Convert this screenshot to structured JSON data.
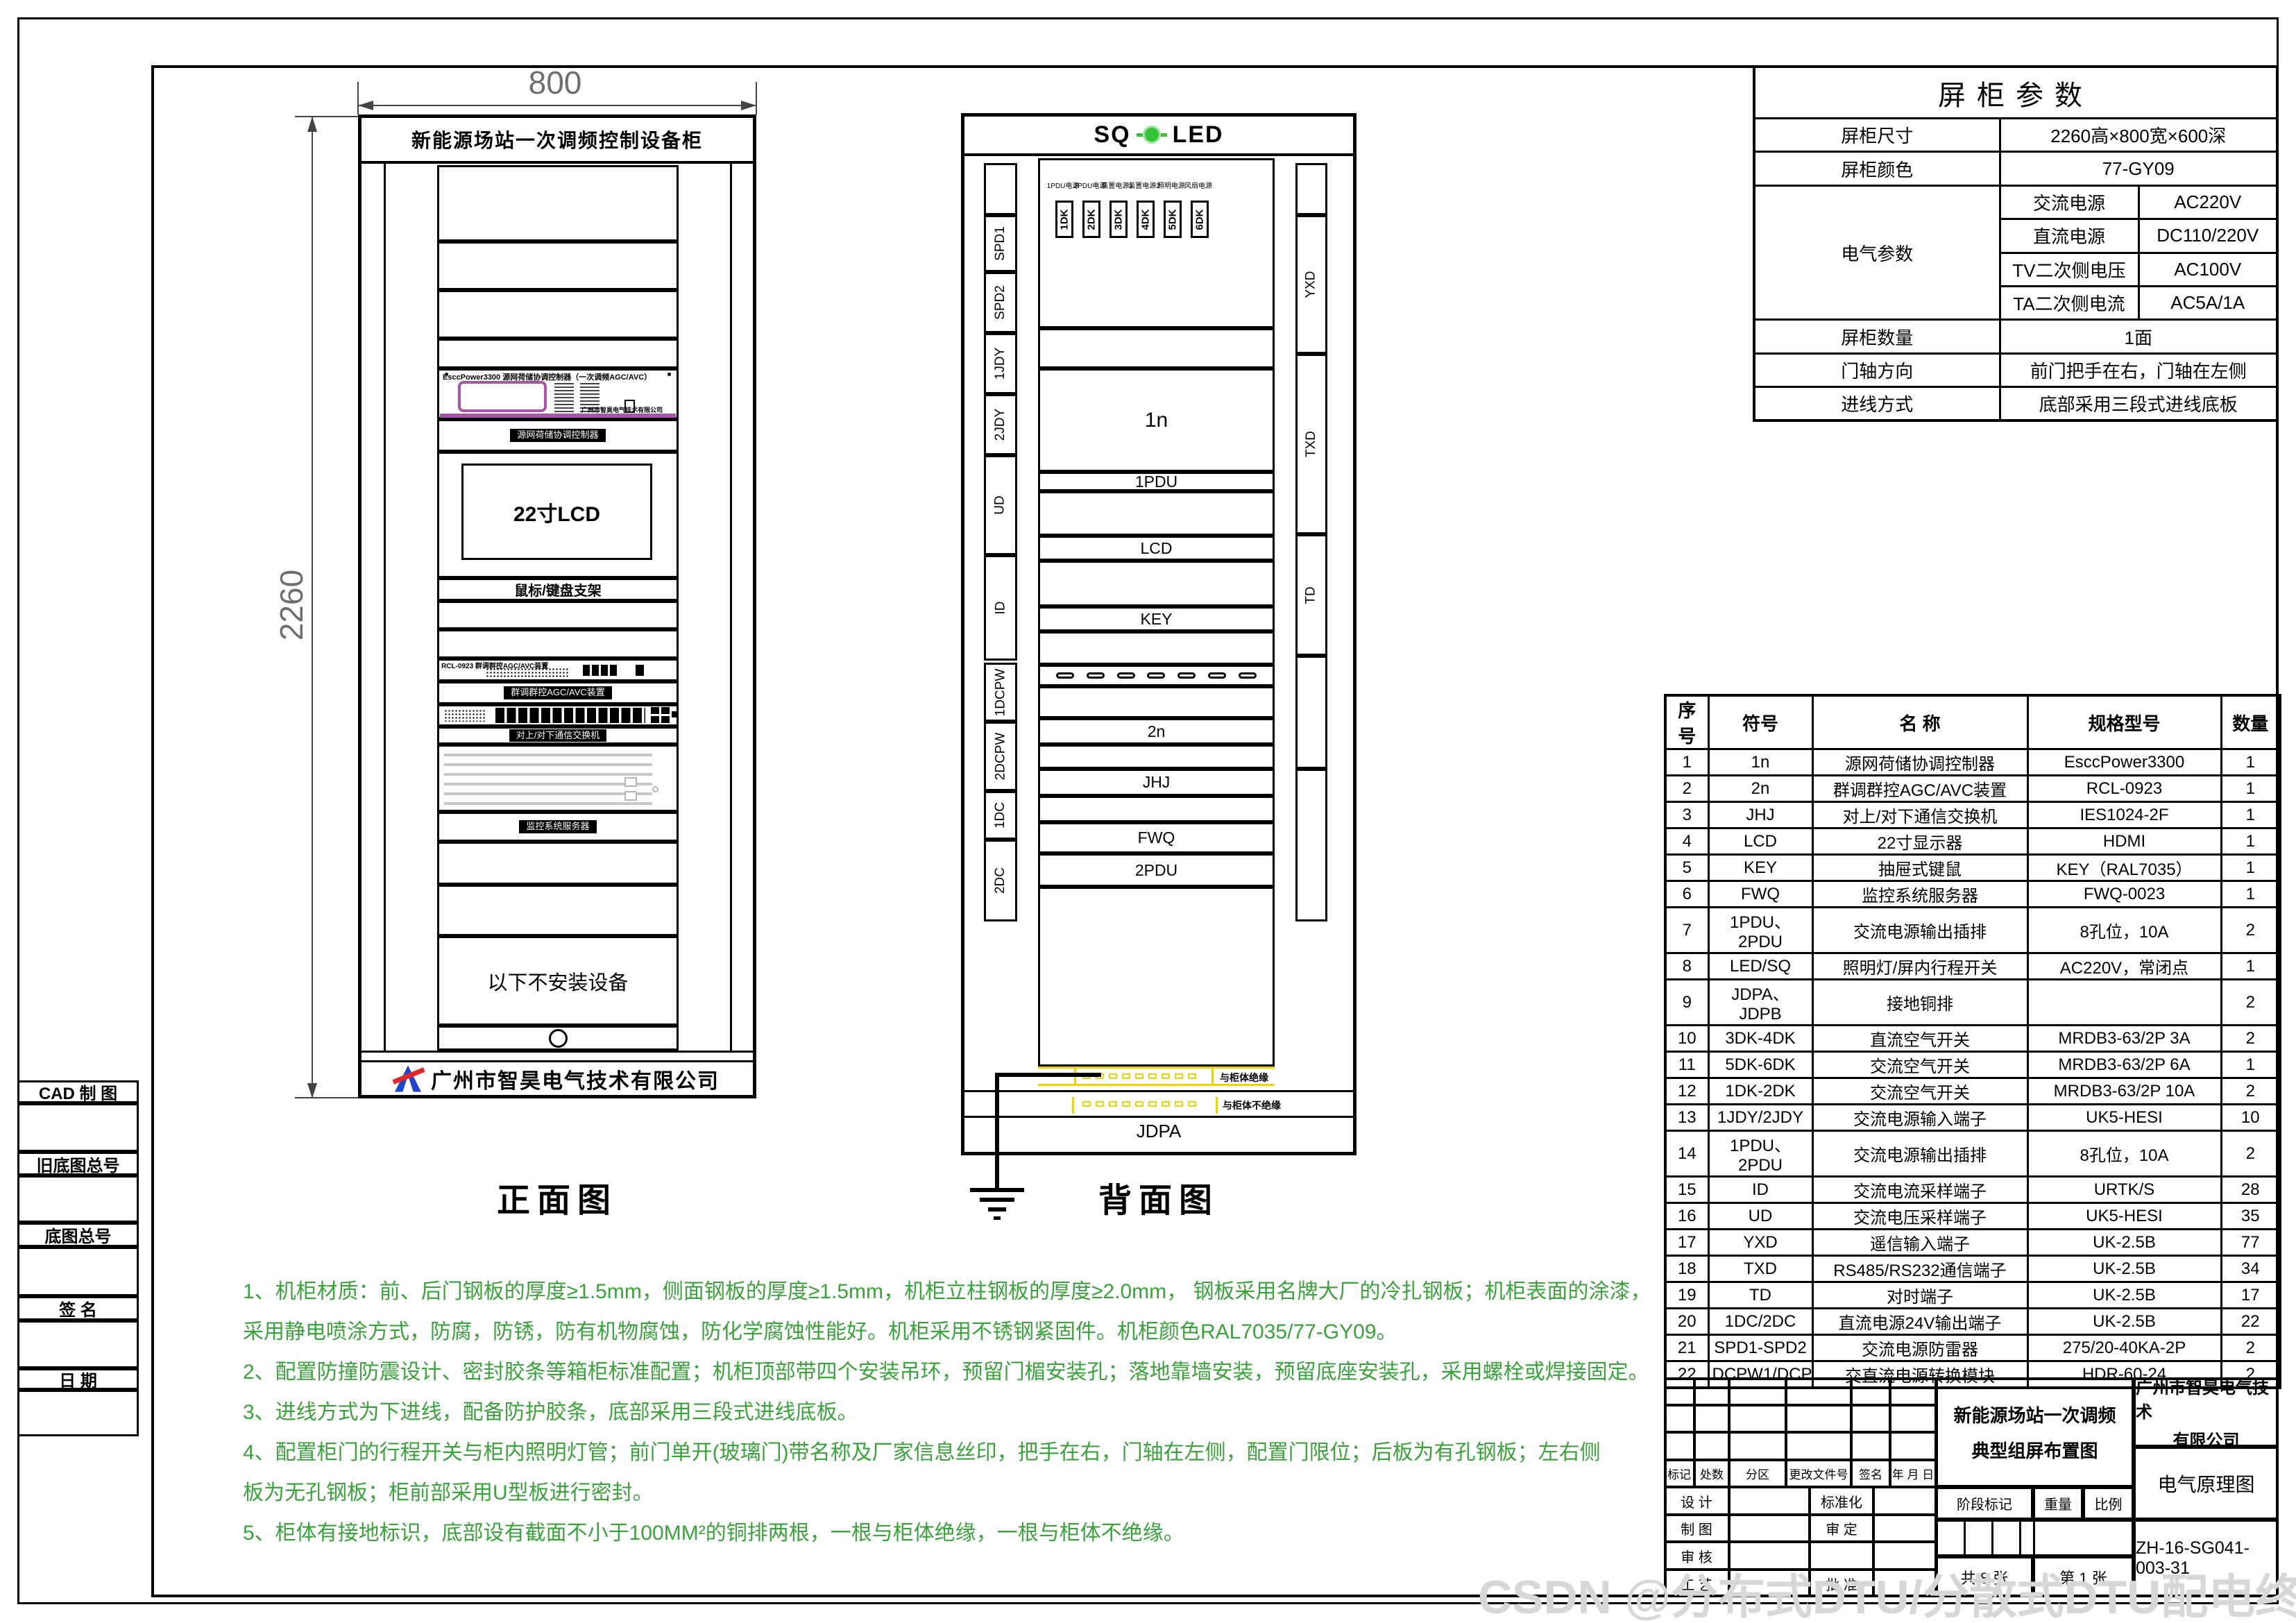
{
  "watermark": "CSDN @分布式DTU/分散式DTU配电终端",
  "side_panel": {
    "labels": [
      "CAD 制 图",
      "旧底图总号",
      "底图总号",
      "签  名",
      "日  期"
    ]
  },
  "front_view": {
    "caption": "正面图",
    "dim_width": "800",
    "dim_height": "2260",
    "header": "新能源场站一次调频控制设备柜",
    "controller_label": "EsccPower3300 源网荷储协调控制器（一次调频AGC/AVC）",
    "controller_brand": "广州市智昊电气技术有限公司",
    "nameplate_controller": "源网荷储协调控制器",
    "switch_label": "RCL-0923 群调群控AGC/AVC装置",
    "nameplate_switch": "群调群控AGC/AVC装置",
    "nameplate_comm": "对上/对下通信交换机",
    "nameplate_server": "监控系统服务器",
    "lcd_label": "22寸LCD",
    "keyboard_label": "鼠标/键盘支架",
    "no_install_label": "以下不安装设备",
    "brand": "广州市智昊电气技术有限公司"
  },
  "back_view": {
    "caption": "背面图",
    "header_left": "SQ",
    "header_right": "LED",
    "breaker_top_labels": [
      "1PDU电源",
      "2PDU电源",
      "装置电源1",
      "装置电源2",
      "照明电源",
      "风扇电源"
    ],
    "breakers": [
      "1DK",
      "2DK",
      "3DK",
      "4DK",
      "5DK",
      "6DK"
    ],
    "left_terminals": [
      "SPD1",
      "SPD2",
      "1JDY",
      "2JDY",
      "UD",
      "ID",
      "1DCPW",
      "2DCPW",
      "1DC",
      "2DC"
    ],
    "right_terminals": [
      "YXD",
      "TXD",
      "TD"
    ],
    "sections": [
      "1n",
      "1PDU",
      "LCD",
      "KEY",
      "2n",
      "JHJ",
      "FWQ",
      "2PDU"
    ],
    "busbar_top_label": "JDPB",
    "busbar_bottom_label": "JDPA",
    "busbar_top_note": "与柜体绝缘",
    "busbar_bottom_note": "与柜体不绝缘"
  },
  "params_table": {
    "title": "屏柜参数",
    "size_label": "屏柜尺寸",
    "size_value": "2260高×800宽×600深",
    "color_label": "屏柜颜色",
    "color_value": "77-GY09",
    "electrical_label": "电气参数",
    "electrical_rows": [
      {
        "label": "交流电源",
        "value": "AC220V"
      },
      {
        "label": "直流电源",
        "value": "DC110/220V"
      },
      {
        "label": "TV二次侧电压",
        "value": "AC100V"
      },
      {
        "label": "TA二次侧电流",
        "value": "AC5A/1A"
      }
    ],
    "count_label": "屏柜数量",
    "count_value": "1面",
    "hinge_label": "门轴方向",
    "hinge_value": "前门把手在右，门轴在左侧",
    "inlet_label": "进线方式",
    "inlet_value": "底部采用三段式进线底板"
  },
  "bom_table": {
    "headers": [
      "序号",
      "符号",
      "名  称",
      "规格型号",
      "数量"
    ],
    "rows": [
      [
        "1",
        "1n",
        "源网荷储协调控制器",
        "EsccPower3300",
        "1"
      ],
      [
        "2",
        "2n",
        "群调群控AGC/AVC装置",
        "RCL-0923",
        "1"
      ],
      [
        "3",
        "JHJ",
        "对上/对下通信交换机",
        "IES1024-2F",
        "1"
      ],
      [
        "4",
        "LCD",
        "22寸显示器",
        "HDMI",
        "1"
      ],
      [
        "5",
        "KEY",
        "抽屉式键鼠",
        "KEY（RAL7035）",
        "1"
      ],
      [
        "6",
        "FWQ",
        "监控系统服务器",
        "FWQ-0023",
        "1"
      ],
      [
        "7",
        "1PDU、2PDU",
        "交流电源输出插排",
        "8孔位，10A",
        "2"
      ],
      [
        "8",
        "LED/SQ",
        "照明灯/屏内行程开关",
        "AC220V，常闭点",
        "1"
      ],
      [
        "9",
        "JDPA、JDPB",
        "接地铜排",
        "",
        "2"
      ],
      [
        "10",
        "3DK-4DK",
        "直流空气开关",
        "MRDB3-63/2P 3A",
        "2"
      ],
      [
        "11",
        "5DK-6DK",
        "交流空气开关",
        "MRDB3-63/2P 6A",
        "1"
      ],
      [
        "12",
        "1DK-2DK",
        "交流空气开关",
        "MRDB3-63/2P 10A",
        "2"
      ],
      [
        "13",
        "1JDY/2JDY",
        "交流电源输入端子",
        "UK5-HESI",
        "10"
      ],
      [
        "14",
        "1PDU、2PDU",
        "交流电源输出插排",
        "8孔位，10A",
        "2"
      ],
      [
        "15",
        "ID",
        "交流电流采样端子",
        "URTK/S",
        "28"
      ],
      [
        "16",
        "UD",
        "交流电压采样端子",
        "UK5-HESI",
        "35"
      ],
      [
        "17",
        "YXD",
        "遥信输入端子",
        "UK-2.5B",
        "77"
      ],
      [
        "18",
        "TXD",
        "RS485/RS232通信端子",
        "UK-2.5B",
        "34"
      ],
      [
        "19",
        "TD",
        "对时端子",
        "UK-2.5B",
        "17"
      ],
      [
        "20",
        "1DC/2DC",
        "直流电源24V输出端子",
        "UK-2.5B",
        "22"
      ],
      [
        "21",
        "SPD1-SPD2",
        "交流电源防雷器",
        "275/20-40KA-2P",
        "2"
      ],
      [
        "22",
        "DCPW1/DCPW2",
        "交直流电源转换模块",
        "HDR-60-24",
        "2"
      ]
    ]
  },
  "title_block": {
    "revision_headers": [
      "标记",
      "处数",
      "分区",
      "更改文件号",
      "签名",
      "年 月 日"
    ],
    "sign_rows": [
      [
        "设 计",
        "",
        "标准化",
        ""
      ],
      [
        "制 图",
        "",
        "审 定",
        ""
      ],
      [
        "审 核",
        "",
        "",
        ""
      ],
      [
        "工 艺",
        "",
        "批 准",
        ""
      ]
    ],
    "project_line1": "新能源场站一次调频",
    "project_line2": "典型组屏布置图",
    "stage_label": "阶段标记",
    "weight_label": "重量",
    "scale_label": "比例",
    "sheets_total": "共 8 张",
    "sheet_no": "第 1 张",
    "company_line1": "广州市智昊电气技术",
    "company_line2": "有限公司",
    "doc_type": "电气原理图",
    "drawing_no": "ZH-16-SG041-003-31"
  },
  "notes": {
    "lines": [
      "1、机柜材质：前、后门钢板的厚度≥1.5mm，侧面钢板的厚度≥1.5mm，机柜立柱钢板的厚度≥2.0mm， 钢板采用名牌大厂的冷扎钢板；机柜表面的涂漆，",
      "采用静电喷涂方式，防腐，防锈，防有机物腐蚀，防化学腐蚀性能好。机柜采用不锈钢紧固件。机柜颜色RAL7035/77-GY09。",
      "2、配置防撞防震设计、密封胶条等箱柜标准配置；机柜顶部带四个安装吊环，预留门楣安装孔；落地靠墙安装，预留底座安装孔，采用螺栓或焊接固定。",
      "3、进线方式为下进线，配备防护胶条，底部采用三段式进线底板。",
      "4、配置柜门的行程开关与柜内照明灯管；前门单开(玻璃门)带名称及厂家信息丝印，把手在右，门轴在左侧，配置门限位；后板为有孔钢板；左右侧",
      "板为无孔钢板；柜前部采用U型板进行密封。",
      "5、柜体有接地标识，底部设有截面不小于100MM²的铜排两根，一根与柜体绝缘，一根与柜体不绝缘。"
    ]
  }
}
